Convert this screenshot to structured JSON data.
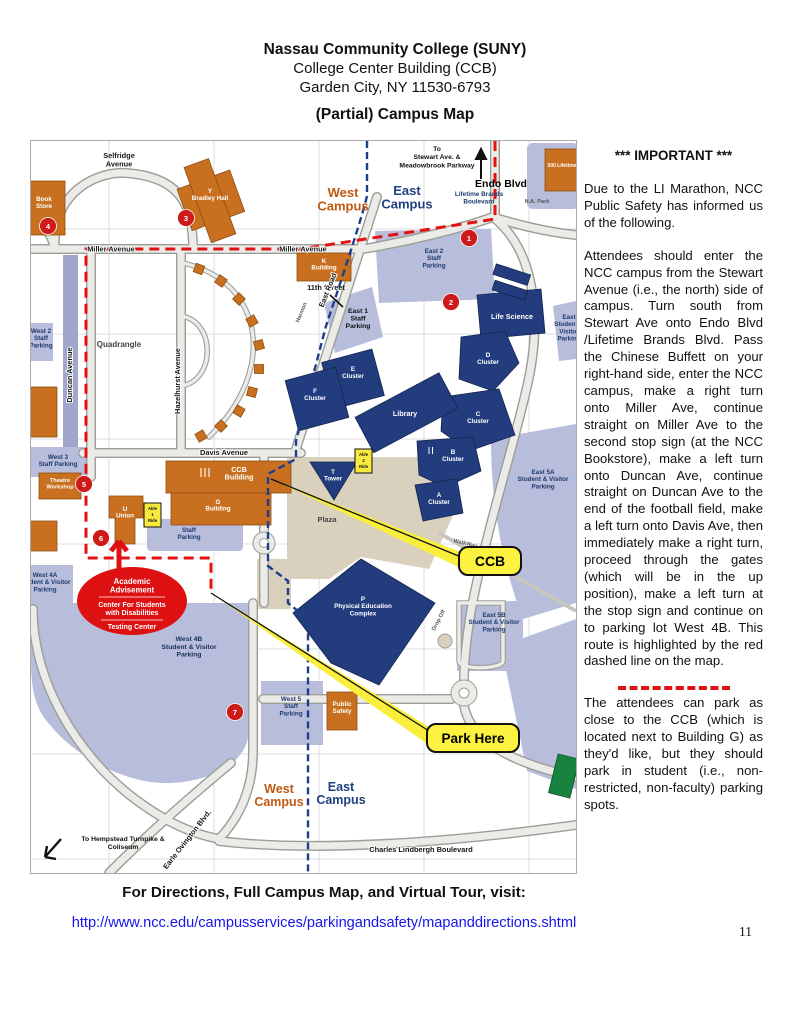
{
  "page": {
    "header": {
      "line1": "Nassau Community College (SUNY)",
      "line2": "College Center Building (CCB)",
      "line3": "Garden City, NY 11530-6793",
      "map_title": "(Partial) Campus Map"
    },
    "footer": {
      "visit_label": "For Directions, Full Campus Map, and Virtual Tour, visit:",
      "link": "http://www.ncc.edu/campusservices/parkingandsafety/mapanddirections.shtml",
      "page_number": "11"
    }
  },
  "notice": {
    "title": "*** IMPORTANT ***",
    "p1": "Due to the LI Marathon, NCC Public Safety has informed us of the following.",
    "p2": "Attendees should enter the NCC campus from the Stewart Avenue (i.e., the north) side of campus. Turn south from Stewart Ave onto Endo Blvd /Lifetime Brands Blvd. Pass the Chinese Buffett on your right-hand side, enter the NCC campus, make a right turn onto Miller Ave, continue straight on Miller Ave to the second stop sign (at the NCC Bookstore), make a left turn onto Duncan Ave, continue straight on Duncan Ave to the end of the football field, make a left turn onto Davis Ave, then immediately make a right turn, proceed through the gates (which will be in the up position), make a left turn at the stop sign and continue on to parking lot West 4B.  This route is highlighted by the red dashed line on the map.",
    "p3": "The attendees can park as close to the CCB (which is located next to Building G) as they'd like, but they should park in student (i.e., non-restricted, non-faculty) parking spots."
  },
  "map": {
    "campus": {
      "west": "West\nCampus",
      "east": "East\nCampus"
    },
    "streets": {
      "selfridge": "Selfridge\nAvenue",
      "miller": "Miller Avenue",
      "eleventh": "11th Street",
      "duncan": "Duncan Avenue",
      "hazelhurst": "Hazelhurst Avenue",
      "quadrangle": "Quadrangle",
      "davis": "Davis Avenue",
      "east_road": "East Road",
      "harmon": "Harmon",
      "to_stewart": "To\nStewart Ave. &\nMeadowbrook Parkway",
      "endo": "Endo Blvd",
      "lifetime": "Lifetime Brands\nBoulevard",
      "na_park": "N.A. Park",
      "earle": "Earle Ovington Blvd.",
      "lindbergh": "Charles Lindbergh Boulevard",
      "hempstead": "To Hempstead Turnpike &\nColiseum",
      "walkway": "WalkWay",
      "dropoff": "Drop Off"
    },
    "buildings": {
      "bookstore": "Book\nStore",
      "bradley": "Y\nBradley Hall",
      "k": "K\nBuilding",
      "lifetime500": "500 Lifetime",
      "ccb": "CCB\nBuilding",
      "g": "G\nBuilding",
      "theatre_workshop": "Theatre\nWorkshop",
      "union": "U\nUnion",
      "public_safety": "Public\nSafety",
      "life_science": "Life Science",
      "d": "D\nCluster",
      "c": "C\nCluster",
      "e": "E\nCluster",
      "f": "F\nCluster",
      "b": "B\nCluster",
      "a": "A\nCluster",
      "library": "Library",
      "tower": "T\nTower",
      "pe": "P\nPhysical Education\nComplex"
    },
    "parking": {
      "east2": "East 2\nStaff\nParking",
      "east1": "East 1\nStaff\nParking",
      "west2": "West 2\nStaff\nParking",
      "west3": "West 3\nStaff Parking",
      "west4a": "West 4A\nStudent & Visitor\nParking",
      "west4b": "West 4B\nStudent & Visitor\nParking",
      "west5": "West 5\nStaff\nParking",
      "east5a": "East 5A\nStudent & Visitor\nParking",
      "east5b": "East 5B\nStudent & Visitor\nParking",
      "staff": "Staff\nParking",
      "east_sv": "East\nStudent &\nVisitor\nParking"
    },
    "callouts": {
      "ccb": "CCB",
      "park": "Park Here"
    },
    "advisement": {
      "a": "Academic\nAdvisement",
      "b": "Center For Students\nwith Disabilities",
      "c": "Testing Center"
    },
    "able": {
      "one": "Able\n1\nRide",
      "two": "Able\n2\nRide"
    },
    "bus": [
      "1",
      "2",
      "3",
      "4",
      "5",
      "6",
      "7"
    ]
  },
  "colors": {
    "route_red": "#e31212",
    "divider_blue": "#1d3d8f",
    "callout_yellow": "#fcf23f",
    "building_orange": "#c8701f",
    "building_navy": "#223c7e",
    "parking_lavender": "#b7bdda",
    "link_blue": "#1414ee"
  }
}
